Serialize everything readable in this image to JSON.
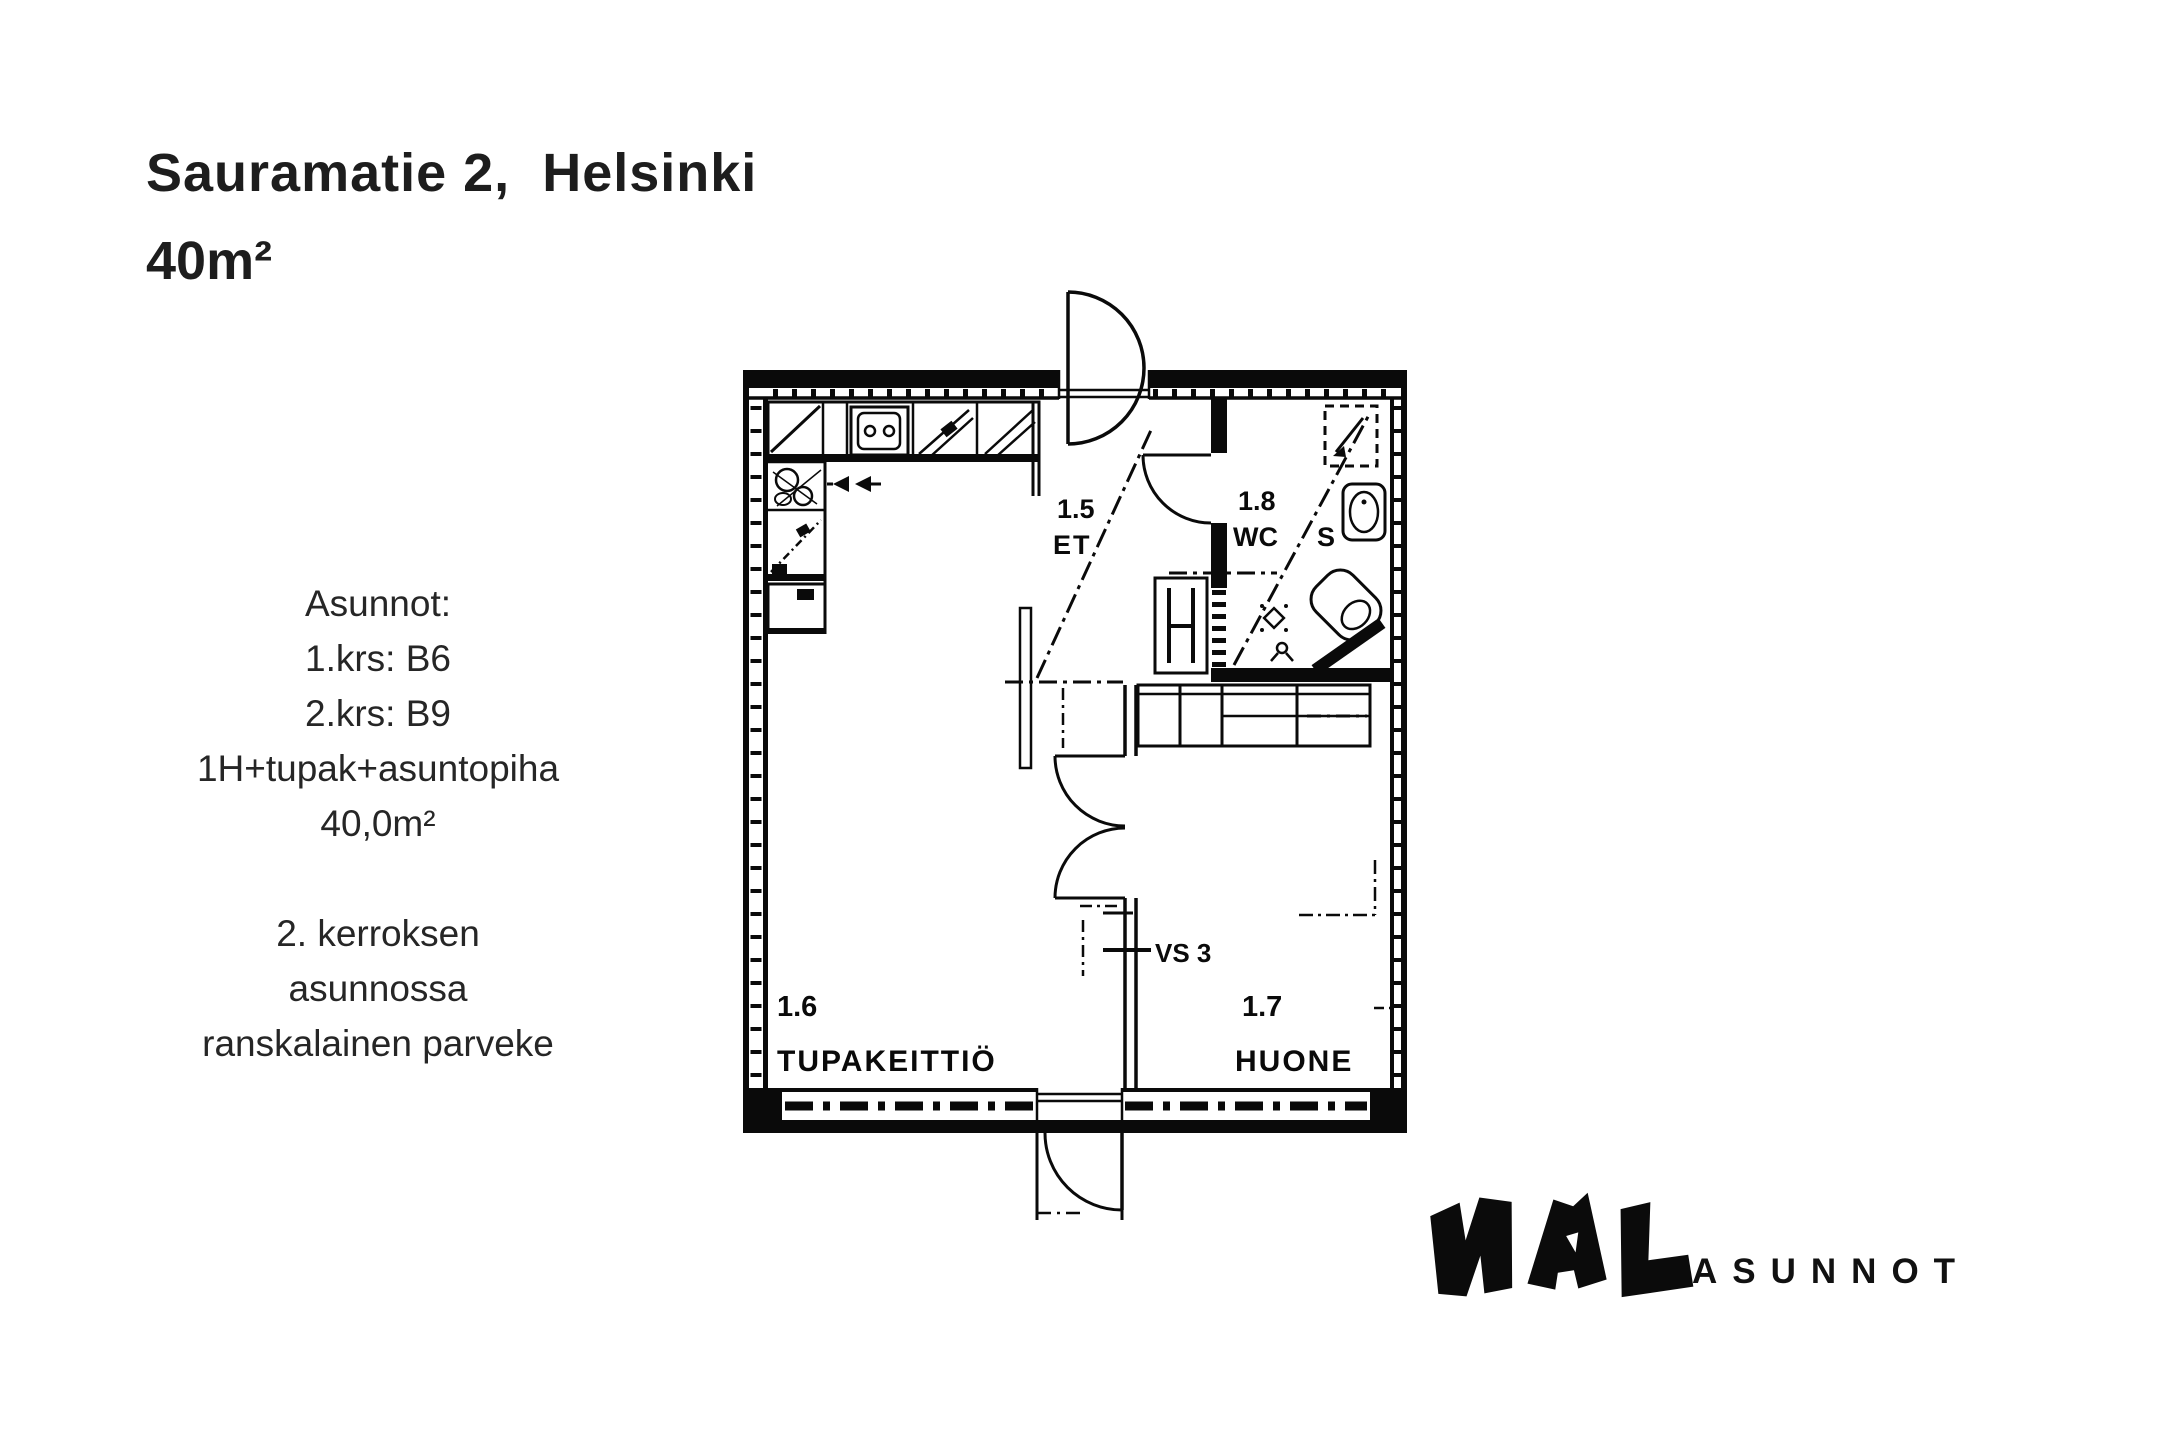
{
  "page": {
    "background": "#ffffff",
    "ink": "#000000",
    "text_color": "#1f1f1f"
  },
  "header": {
    "title": "Sauramatie 2,  Helsinki",
    "area": "40m²"
  },
  "apartments": {
    "lines": [
      "Asunnot:",
      "1.krs: B6",
      "2.krs: B9",
      "1H+tupak+asuntopiha",
      "40,0m²"
    ]
  },
  "note": {
    "lines": [
      "2. kerroksen",
      "asunnossa",
      "ranskalainen parveke"
    ]
  },
  "floorplan": {
    "rooms": [
      {
        "number": "1.5",
        "name": "ET"
      },
      {
        "number": "1.8",
        "name": "WC",
        "suffix": "S"
      },
      {
        "number": "1.6",
        "name": "TUPAKEITTIÖ"
      },
      {
        "number": "1.7",
        "name": "HUONE"
      }
    ],
    "wall_label": "VS 3"
  },
  "logo": {
    "name": "NAL",
    "wordmark": "ASUNNOT"
  }
}
